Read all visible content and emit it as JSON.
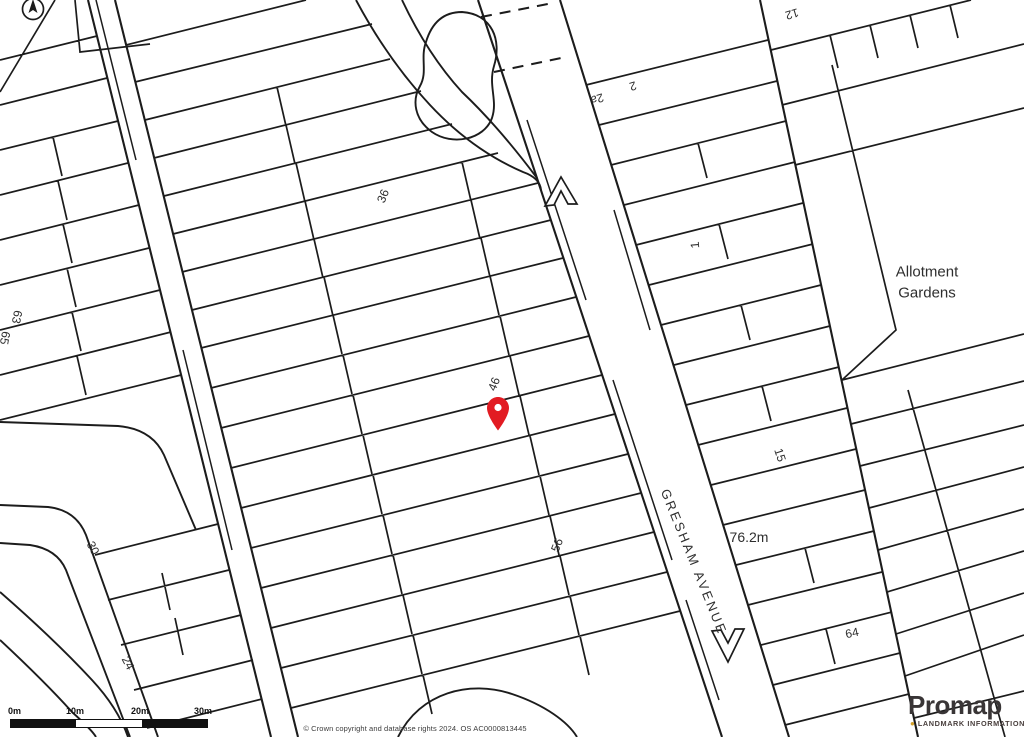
{
  "map": {
    "pin_color": "#e21b22",
    "line_color": "#1c1c1c",
    "labels": [
      {
        "text": "36",
        "x": 383,
        "y": 196,
        "rot": -68,
        "size": 12
      },
      {
        "text": "46",
        "x": 494,
        "y": 384,
        "rot": -68,
        "size": 12
      },
      {
        "text": "56",
        "x": 557,
        "y": 545,
        "rot": -68,
        "size": 12
      },
      {
        "text": "63",
        "x": 17,
        "y": 317,
        "rot": 100,
        "size": 12
      },
      {
        "text": "65",
        "x": 5,
        "y": 338,
        "rot": 100,
        "size": 12
      },
      {
        "text": "30",
        "x": 93,
        "y": 548,
        "rot": 62,
        "size": 12
      },
      {
        "text": "24",
        "x": 128,
        "y": 663,
        "rot": 62,
        "size": 12
      },
      {
        "text": "15",
        "x": 780,
        "y": 455,
        "rot": 72,
        "size": 12
      },
      {
        "text": "1",
        "x": 695,
        "y": 245,
        "rot": -95,
        "size": 12
      },
      {
        "text": "2a",
        "x": 597,
        "y": 99,
        "rot": 163,
        "size": 12
      },
      {
        "text": "2",
        "x": 633,
        "y": 86,
        "rot": 163,
        "size": 12
      },
      {
        "text": "12",
        "x": 792,
        "y": 14,
        "rot": 163,
        "size": 12
      },
      {
        "text": "64",
        "x": 852,
        "y": 633,
        "rot": -12,
        "size": 12
      },
      {
        "text": "76.2m",
        "x": 749,
        "y": 537,
        "rot": 0,
        "size": 14
      },
      {
        "text": "GRESHAM AVENUE",
        "x": 694,
        "y": 562,
        "rot": 68,
        "size": 13,
        "spacing": 2.5
      },
      {
        "text": "Allotment",
        "x": 927,
        "y": 272,
        "rot": 0,
        "size": 15
      },
      {
        "text": "Gardens",
        "x": 927,
        "y": 293,
        "rot": 0,
        "size": 15
      }
    ]
  },
  "scale_bar": {
    "ticks": [
      "0m",
      "10m",
      "20m",
      "30m"
    ]
  },
  "attribution": {
    "copyright": "© Crown copyright and database rights 2024. OS AC0000813445"
  },
  "branding": {
    "name": "Promap",
    "tagline": "LANDMARK INFORMATION",
    "accent": "#d3a029"
  }
}
